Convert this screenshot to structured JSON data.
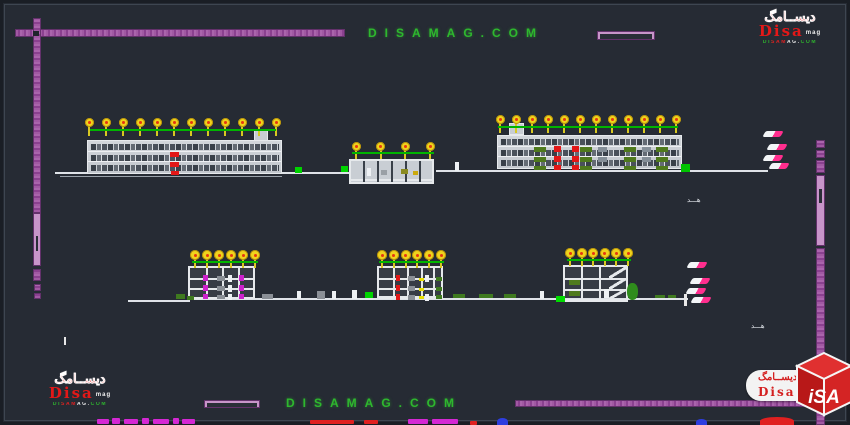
{
  "watermark": {
    "top": "DISAMAG.COM",
    "bottom": "DISAMAG.COM",
    "color": "#2eb82e"
  },
  "logos": {
    "arabic": "ديســامگ",
    "name": "Disa",
    "suffix": "mag",
    "url": "DISAMAG.COM",
    "cube_text": "iSA"
  },
  "annotations": {
    "top_label": "هـــد",
    "bottom_label": "هـــد"
  },
  "colors": {
    "background": "#262b34",
    "border_bar_purple": "#9a4e9c",
    "border_bar_light": "#c795c9",
    "tree_canopy_yellow": "#f0d31d",
    "tree_core_red": "#e53513",
    "green_line": "#00b400",
    "building_line": "#e6e9ec",
    "ground_line": "#dfe3e8",
    "watermark_green": "#2eb82e",
    "brand_red": "#d41f1f",
    "shrub_green": "#4f7a1d",
    "plant_magenta": "#cc22cc",
    "flag_pink": "#ff2e8e"
  },
  "drawing": {
    "bars": [
      {
        "x": 15,
        "y": 29,
        "w": 330,
        "h": 8,
        "o": "h"
      },
      {
        "x": 33,
        "y": 18,
        "w": 8,
        "h": 195,
        "o": "v"
      },
      {
        "x": 33,
        "y": 213,
        "w": 8,
        "h": 53,
        "o": "v",
        "light": 1,
        "inner": [
          22,
          15
        ]
      },
      {
        "x": 33,
        "y": 269,
        "w": 8,
        "h": 12,
        "o": "v"
      },
      {
        "x": 34,
        "y": 284,
        "w": 7,
        "h": 7,
        "o": "v"
      },
      {
        "x": 34,
        "y": 293,
        "w": 7,
        "h": 6,
        "o": "v"
      },
      {
        "x": 816,
        "y": 140,
        "w": 9,
        "h": 8,
        "o": "v"
      },
      {
        "x": 816,
        "y": 150,
        "w": 9,
        "h": 8,
        "o": "v"
      },
      {
        "x": 816,
        "y": 160,
        "w": 9,
        "h": 13,
        "o": "v"
      },
      {
        "x": 816,
        "y": 175,
        "w": 9,
        "h": 71,
        "o": "v",
        "light": 1,
        "inner": [
          13,
          14
        ]
      },
      {
        "x": 816,
        "y": 248,
        "w": 9,
        "h": 177,
        "o": "v"
      },
      {
        "x": 515,
        "y": 400,
        "w": 303,
        "h": 7,
        "o": "h"
      },
      {
        "x": 597,
        "y": 31,
        "w": 58,
        "h": 9,
        "o": "h",
        "light": 1,
        "inner": [
          2,
          5
        ]
      },
      {
        "x": 204,
        "y": 400,
        "w": 56,
        "h": 8,
        "o": "h",
        "light": 1,
        "inner": [
          2,
          4
        ]
      }
    ],
    "ground_lines": [
      {
        "x": 55,
        "y": 172,
        "w": 294,
        "h": 2
      },
      {
        "x": 60,
        "y": 176,
        "w": 222,
        "h": 1,
        "c": "#9aa2ab"
      },
      {
        "x": 436,
        "y": 170,
        "w": 332,
        "h": 2
      },
      {
        "x": 128,
        "y": 300,
        "w": 62,
        "h": 2
      },
      {
        "x": 188,
        "y": 298,
        "w": 500,
        "h": 2
      }
    ],
    "buildings": [
      {
        "id": "elevation-left",
        "style": "elevation",
        "x": 87,
        "y": 140,
        "w": 195,
        "h": 34,
        "floors": 3,
        "tower": {
          "x": 167,
          "y": -10,
          "w": 14,
          "h": 11
        },
        "marks": [
          {
            "x": 82,
            "y": 11,
            "w": 9,
            "h": 5,
            "c": "#e21717"
          },
          {
            "x": 82,
            "y": 21,
            "w": 9,
            "h": 5,
            "c": "#e21717"
          },
          {
            "x": 83,
            "y": 30,
            "w": 8,
            "h": 4,
            "c": "#e21717"
          }
        ]
      },
      {
        "id": "pavilion-center",
        "style": "section",
        "x": 349,
        "y": 159,
        "w": 85,
        "h": 25,
        "fill": "#c9ced4",
        "slabs": [
          18
        ],
        "cols": [
          12,
          26,
          40,
          54,
          68
        ],
        "marks": [
          {
            "x": 16,
            "y": 7,
            "w": 4,
            "h": 8,
            "c": "#eef1f4"
          },
          {
            "x": 30,
            "y": 9,
            "w": 6,
            "h": 5,
            "c": "#9aa0a6"
          },
          {
            "x": 50,
            "y": 8,
            "w": 7,
            "h": 5,
            "c": "#8a8a20"
          },
          {
            "x": 62,
            "y": 10,
            "w": 5,
            "h": 4,
            "c": "#caa90e"
          }
        ]
      },
      {
        "id": "elevation-right",
        "style": "elevation",
        "x": 497,
        "y": 135,
        "w": 185,
        "h": 34,
        "floors": 3,
        "tower": {
          "x": 12,
          "y": -12,
          "w": 15,
          "h": 12
        },
        "marks": [
          {
            "x": 36,
            "y": 11,
            "w": 12,
            "h": 5,
            "c": "#4f7a1d"
          },
          {
            "x": 36,
            "y": 21,
            "w": 12,
            "h": 5,
            "c": "#4f7a1d"
          },
          {
            "x": 36,
            "y": 30,
            "w": 12,
            "h": 4,
            "c": "#4f7a1d"
          },
          {
            "x": 82,
            "y": 11,
            "w": 12,
            "h": 5,
            "c": "#4f7a1d"
          },
          {
            "x": 82,
            "y": 21,
            "w": 12,
            "h": 5,
            "c": "#4f7a1d"
          },
          {
            "x": 82,
            "y": 30,
            "w": 12,
            "h": 4,
            "c": "#4f7a1d"
          },
          {
            "x": 126,
            "y": 11,
            "w": 12,
            "h": 5,
            "c": "#4f7a1d"
          },
          {
            "x": 126,
            "y": 21,
            "w": 12,
            "h": 5,
            "c": "#4f7a1d"
          },
          {
            "x": 126,
            "y": 30,
            "w": 12,
            "h": 4,
            "c": "#4f7a1d"
          },
          {
            "x": 158,
            "y": 11,
            "w": 12,
            "h": 5,
            "c": "#4f7a1d"
          },
          {
            "x": 158,
            "y": 21,
            "w": 12,
            "h": 5,
            "c": "#4f7a1d"
          },
          {
            "x": 158,
            "y": 30,
            "w": 12,
            "h": 4,
            "c": "#4f7a1d"
          },
          {
            "x": 56,
            "y": 10,
            "w": 7,
            "h": 6,
            "c": "#e21717"
          },
          {
            "x": 56,
            "y": 20,
            "w": 7,
            "h": 6,
            "c": "#e21717"
          },
          {
            "x": 56,
            "y": 29,
            "w": 7,
            "h": 5,
            "c": "#e21717"
          },
          {
            "x": 74,
            "y": 10,
            "w": 7,
            "h": 6,
            "c": "#e21717"
          },
          {
            "x": 74,
            "y": 20,
            "w": 7,
            "h": 6,
            "c": "#e21717"
          },
          {
            "x": 74,
            "y": 29,
            "w": 7,
            "h": 5,
            "c": "#e21717"
          },
          {
            "x": 100,
            "y": 11,
            "w": 9,
            "h": 5,
            "c": "#858f98"
          },
          {
            "x": 100,
            "y": 21,
            "w": 9,
            "h": 5,
            "c": "#858f98"
          },
          {
            "x": 144,
            "y": 11,
            "w": 9,
            "h": 5,
            "c": "#858f98"
          },
          {
            "x": 144,
            "y": 21,
            "w": 9,
            "h": 5,
            "c": "#858f98"
          }
        ]
      },
      {
        "id": "section-left",
        "style": "section",
        "x": 188,
        "y": 266,
        "w": 67,
        "h": 33,
        "slabs": [
          10,
          20,
          29
        ],
        "cols": [
          16,
          32,
          48
        ],
        "marks": [
          {
            "x": 13,
            "y": 7,
            "w": 5,
            "h": 6,
            "c": "#cc22cc"
          },
          {
            "x": 49,
            "y": 7,
            "w": 5,
            "h": 6,
            "c": "#cc22cc"
          },
          {
            "x": 13,
            "y": 17,
            "w": 5,
            "h": 6,
            "c": "#cc22cc"
          },
          {
            "x": 49,
            "y": 17,
            "w": 5,
            "h": 6,
            "c": "#cc22cc"
          },
          {
            "x": 13,
            "y": 26,
            "w": 5,
            "h": 5,
            "c": "#cc22cc"
          },
          {
            "x": 49,
            "y": 26,
            "w": 5,
            "h": 5,
            "c": "#cc22cc"
          },
          {
            "x": 27,
            "y": 8,
            "w": 8,
            "h": 5,
            "c": "#8a8f96"
          },
          {
            "x": 27,
            "y": 18,
            "w": 8,
            "h": 5,
            "c": "#8a8f96"
          },
          {
            "x": 27,
            "y": 27,
            "w": 8,
            "h": 4,
            "c": "#8a8f96"
          },
          {
            "x": 38,
            "y": 7,
            "w": 4,
            "h": 7,
            "c": "#eef1f4"
          },
          {
            "x": 38,
            "y": 17,
            "w": 4,
            "h": 7,
            "c": "#eef1f4"
          },
          {
            "x": 38,
            "y": 26,
            "w": 4,
            "h": 6,
            "c": "#eef1f4"
          }
        ]
      },
      {
        "id": "section-middle",
        "style": "section",
        "x": 377,
        "y": 266,
        "w": 66,
        "h": 32,
        "slabs": [
          10,
          20,
          29
        ],
        "cols": [
          14,
          28,
          42,
          54
        ],
        "marks": [
          {
            "x": 17,
            "y": 7,
            "w": 4,
            "h": 6,
            "c": "#e21717"
          },
          {
            "x": 17,
            "y": 17,
            "w": 4,
            "h": 6,
            "c": "#e21717"
          },
          {
            "x": 17,
            "y": 26,
            "w": 4,
            "h": 6,
            "c": "#e21717"
          },
          {
            "x": 29,
            "y": 8,
            "w": 7,
            "h": 5,
            "c": "#8a8f96"
          },
          {
            "x": 29,
            "y": 18,
            "w": 7,
            "h": 5,
            "c": "#8a8f96"
          },
          {
            "x": 29,
            "y": 27,
            "w": 7,
            "h": 5,
            "c": "#8a8f96"
          },
          {
            "x": 40,
            "y": 10,
            "w": 5,
            "h": 3,
            "c": "#e8e000"
          },
          {
            "x": 40,
            "y": 20,
            "w": 5,
            "h": 3,
            "c": "#e8e000"
          },
          {
            "x": 40,
            "y": 28,
            "w": 5,
            "h": 3,
            "c": "#e8e000"
          },
          {
            "x": 46,
            "y": 7,
            "w": 4,
            "h": 7,
            "c": "#eef1f4"
          },
          {
            "x": 46,
            "y": 26,
            "w": 4,
            "h": 7,
            "c": "#eef1f4"
          },
          {
            "x": 57,
            "y": 9,
            "w": 6,
            "h": 4,
            "c": "#3f7a1f"
          },
          {
            "x": 57,
            "y": 19,
            "w": 6,
            "h": 4,
            "c": "#3f7a1f"
          },
          {
            "x": 57,
            "y": 27,
            "w": 6,
            "h": 4,
            "c": "#3f7a1f"
          }
        ]
      },
      {
        "id": "section-right",
        "style": "section",
        "x": 563,
        "y": 265,
        "w": 65,
        "h": 37,
        "slabs": [
          11,
          22,
          32
        ],
        "cols": [
          16,
          34
        ],
        "stairs": {
          "x": 44,
          "w": 18
        },
        "marks": [
          {
            "x": 4,
            "y": 13,
            "w": 11,
            "h": 5,
            "c": "#4f7a1d"
          },
          {
            "x": 4,
            "y": 24,
            "w": 11,
            "h": 5,
            "c": "#4f7a1d"
          }
        ]
      }
    ],
    "trees": [
      {
        "n": 12,
        "x0": 89,
        "x1": 276,
        "cy": 122,
        "s": 9,
        "ly": 129
      },
      {
        "n": 4,
        "x0": 356,
        "x1": 430,
        "cy": 146,
        "s": 9,
        "ly": 152
      },
      {
        "n": 12,
        "x0": 500,
        "x1": 676,
        "cy": 119,
        "s": 9,
        "ly": 126
      },
      {
        "n": 6,
        "x0": 195,
        "x1": 255,
        "cy": 255,
        "s": 10,
        "ly": 261
      },
      {
        "n": 6,
        "x0": 382,
        "x1": 441,
        "cy": 255,
        "s": 10,
        "ly": 261
      },
      {
        "n": 6,
        "x0": 570,
        "x1": 628,
        "cy": 253,
        "s": 10,
        "ly": 259
      }
    ],
    "green_lines": [
      {
        "x": 90,
        "y": 129,
        "w": 186
      },
      {
        "x": 352,
        "y": 152,
        "w": 82
      },
      {
        "x": 498,
        "y": 126,
        "w": 180
      },
      {
        "x": 192,
        "y": 261,
        "w": 66
      },
      {
        "x": 379,
        "y": 261,
        "w": 65
      },
      {
        "x": 567,
        "y": 259,
        "w": 64
      }
    ],
    "marks": [
      {
        "x": 295,
        "y": 167,
        "w": 7,
        "h": 6,
        "c": "#00d400"
      },
      {
        "x": 341,
        "y": 166,
        "w": 7,
        "h": 6,
        "c": "#00d400"
      },
      {
        "x": 681,
        "y": 164,
        "w": 9,
        "h": 8,
        "c": "#00c400"
      },
      {
        "x": 455,
        "y": 162,
        "w": 4,
        "h": 9,
        "c": "#eef1f4"
      },
      {
        "x": 33,
        "y": 31,
        "w": 6,
        "h": 5,
        "c": "#20242b"
      },
      {
        "x": 64,
        "y": 337,
        "w": 2,
        "h": 8,
        "c": "#e8e8e8"
      },
      {
        "x": 176,
        "y": 294,
        "w": 9,
        "h": 5,
        "c": "#3f7a1f"
      },
      {
        "x": 187,
        "y": 296,
        "w": 7,
        "h": 4,
        "c": "#3f7a1f"
      },
      {
        "x": 262,
        "y": 294,
        "w": 11,
        "h": 5,
        "c": "#8a8f96"
      },
      {
        "x": 297,
        "y": 291,
        "w": 4,
        "h": 8,
        "c": "#eef1f4"
      },
      {
        "x": 317,
        "y": 291,
        "w": 8,
        "h": 8,
        "c": "#8a8f96"
      },
      {
        "x": 332,
        "y": 291,
        "w": 4,
        "h": 8,
        "c": "#eef1f4"
      },
      {
        "x": 352,
        "y": 290,
        "w": 5,
        "h": 9,
        "c": "#eef1f4"
      },
      {
        "x": 365,
        "y": 292,
        "w": 8,
        "h": 6,
        "c": "#00d400"
      },
      {
        "x": 453,
        "y": 294,
        "w": 12,
        "h": 4,
        "c": "#3f7a1f"
      },
      {
        "x": 479,
        "y": 294,
        "w": 14,
        "h": 4,
        "c": "#3f7a1f"
      },
      {
        "x": 504,
        "y": 294,
        "w": 12,
        "h": 4,
        "c": "#3f7a1f"
      },
      {
        "x": 540,
        "y": 291,
        "w": 4,
        "h": 8,
        "c": "#eef1f4"
      },
      {
        "x": 556,
        "y": 296,
        "w": 9,
        "h": 6,
        "c": "#00dc00"
      },
      {
        "x": 604,
        "y": 289,
        "w": 5,
        "h": 9,
        "c": "#eef1f4"
      },
      {
        "x": 627,
        "y": 283,
        "w": 11,
        "h": 17,
        "c": "#2f8c1c",
        "r": 1
      },
      {
        "x": 655,
        "y": 295,
        "w": 10,
        "h": 3,
        "c": "#3f7a1f"
      },
      {
        "x": 668,
        "y": 295,
        "w": 8,
        "h": 3,
        "c": "#3f7a1f"
      },
      {
        "x": 684,
        "y": 294,
        "w": 3,
        "h": 12,
        "c": "#e8e8e8"
      }
    ],
    "flags": [
      {
        "x": 764,
        "y": 131
      },
      {
        "x": 768,
        "y": 144
      },
      {
        "x": 764,
        "y": 155
      },
      {
        "x": 770,
        "y": 163
      },
      {
        "x": 688,
        "y": 262
      },
      {
        "x": 691,
        "y": 278
      },
      {
        "x": 687,
        "y": 288
      },
      {
        "x": 692,
        "y": 297
      }
    ],
    "fragments": [
      {
        "x": 97,
        "y": 419,
        "w": 12,
        "h": 5,
        "c": "#d428d4"
      },
      {
        "x": 112,
        "y": 418,
        "w": 8,
        "h": 6,
        "c": "#d428d4"
      },
      {
        "x": 124,
        "y": 419,
        "w": 14,
        "h": 5,
        "c": "#d428d4"
      },
      {
        "x": 142,
        "y": 418,
        "w": 7,
        "h": 6,
        "c": "#d428d4"
      },
      {
        "x": 153,
        "y": 419,
        "w": 16,
        "h": 5,
        "c": "#d428d4"
      },
      {
        "x": 173,
        "y": 418,
        "w": 6,
        "h": 6,
        "c": "#d428d4"
      },
      {
        "x": 182,
        "y": 419,
        "w": 13,
        "h": 5,
        "c": "#d428d4"
      },
      {
        "x": 310,
        "y": 420,
        "w": 44,
        "h": 4,
        "c": "#e02020"
      },
      {
        "x": 364,
        "y": 420,
        "w": 14,
        "h": 4,
        "c": "#e02020"
      },
      {
        "x": 408,
        "y": 419,
        "w": 20,
        "h": 5,
        "c": "#d428d4"
      },
      {
        "x": 432,
        "y": 419,
        "w": 26,
        "h": 5,
        "c": "#d428d4"
      },
      {
        "x": 470,
        "y": 421,
        "w": 7,
        "h": 4,
        "c": "#e02020"
      },
      {
        "x": 497,
        "y": 418,
        "w": 11,
        "h": 7,
        "c": "#2e3ee0",
        "r": 1
      },
      {
        "x": 696,
        "y": 419,
        "w": 11,
        "h": 6,
        "c": "#2e3ee0",
        "r": 1
      },
      {
        "x": 760,
        "y": 417,
        "w": 34,
        "h": 8,
        "c": "#e02020",
        "r": 1
      }
    ]
  }
}
